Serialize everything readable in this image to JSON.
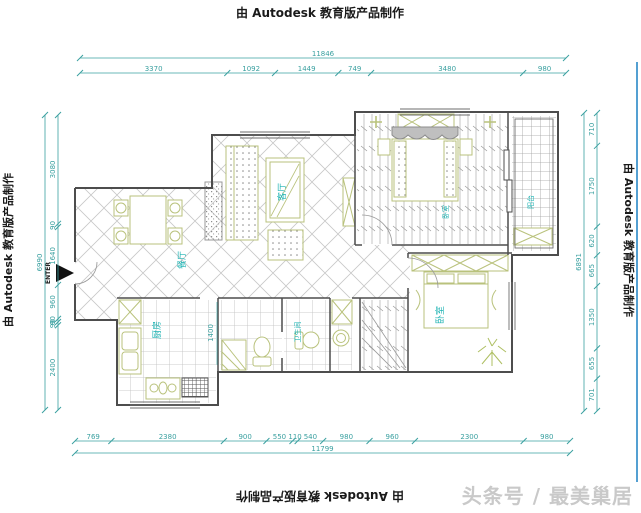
{
  "watermark": {
    "text": "由 Autodesk 教育版产品制作"
  },
  "branding": {
    "text": "头条号 / 最美巢居"
  },
  "dimensions": {
    "top": {
      "overall": "11846",
      "segments": [
        "3370",
        "1092",
        "1449",
        "749",
        "3480",
        "980"
      ]
    },
    "bottom": {
      "overall": "11799",
      "segments": [
        "769",
        "2380",
        "900",
        "550",
        "110",
        "540",
        "980",
        "960",
        "2300",
        "980"
      ]
    },
    "left": {
      "overall": "6990",
      "segments": [
        "3080",
        "90",
        "1640",
        "960",
        "90",
        "90",
        "2400"
      ]
    },
    "right": {
      "overall": "6891",
      "segments": [
        "710",
        "1750",
        "620",
        "665",
        "1350",
        "655",
        "701"
      ]
    }
  },
  "labels": {
    "dining": "餐厅",
    "living": "客厅",
    "kitchen": "厨房",
    "bathroom": "卫生间",
    "bedroom": "卧室",
    "master_bedroom": "卧室",
    "balcony": "阳台",
    "enter": "ENTER",
    "hall_width": "1400"
  },
  "colors": {
    "dimension": "#3aa0a0",
    "room_label": "#1fb3b3",
    "furniture": "#b9c27c",
    "wall": "#4d4d4d",
    "hatch": "#c8c8c8",
    "educational_text": "#1a1a1a",
    "branding_gray": "#c9c9c9",
    "accent_blue_line": "#54a0d2"
  }
}
